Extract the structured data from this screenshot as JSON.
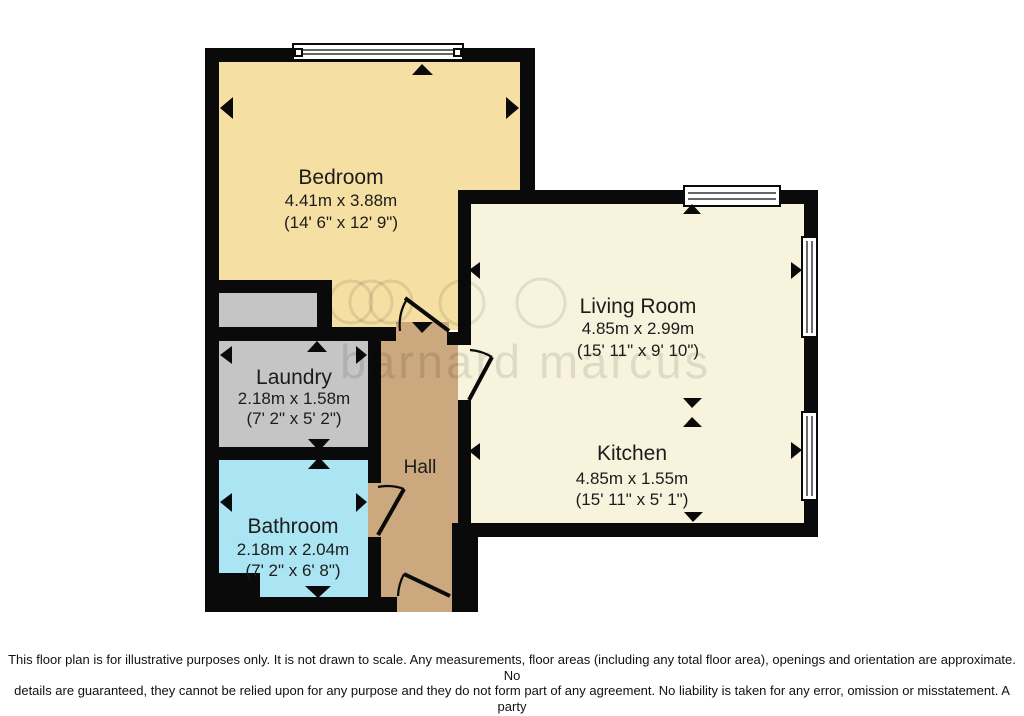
{
  "floorplan": {
    "rooms": {
      "bedroom": {
        "name": "Bedroom",
        "metric": "4.41m x 3.88m",
        "imperial": "(14' 6\" x 12' 9\")"
      },
      "living_room": {
        "name": "Living Room",
        "metric": "4.85m x 2.99m",
        "imperial": "(15' 11\" x 9' 10\")"
      },
      "kitchen": {
        "name": "Kitchen",
        "metric": "4.85m x 1.55m",
        "imperial": "(15' 11\" x 5' 1\")"
      },
      "laundry": {
        "name": "Laundry",
        "metric": "2.18m x 1.58m",
        "imperial": "(7' 2\" x 5' 2\")"
      },
      "bathroom": {
        "name": "Bathroom",
        "metric": "2.18m x 2.04m",
        "imperial": "(7' 2\" x 6' 8\")"
      },
      "hall": {
        "name": "Hall"
      }
    },
    "watermark": "barnard marcus",
    "colors": {
      "wall": "#0a0a0a",
      "bedroom": "#f6dfa2",
      "living_kitchen": "#f8f3dc",
      "laundry": "#c5c5c5",
      "closet": "#c5c5c5",
      "bathroom": "#abe5f3",
      "hall": "#cba87d"
    }
  },
  "disclaimer": {
    "lines": [
      "This floor plan is for illustrative purposes only. It is not drawn to scale. Any measurements, floor areas (including any total floor area), openings and orientation are approximate. No",
      "details are guaranteed, they cannot be relied upon for any purpose and they do not form part of any agreement. No liability is taken for any error, omission or misstatement. A party",
      "must rely upon its own inspection(s). Powered by www.focalagent.com"
    ]
  }
}
